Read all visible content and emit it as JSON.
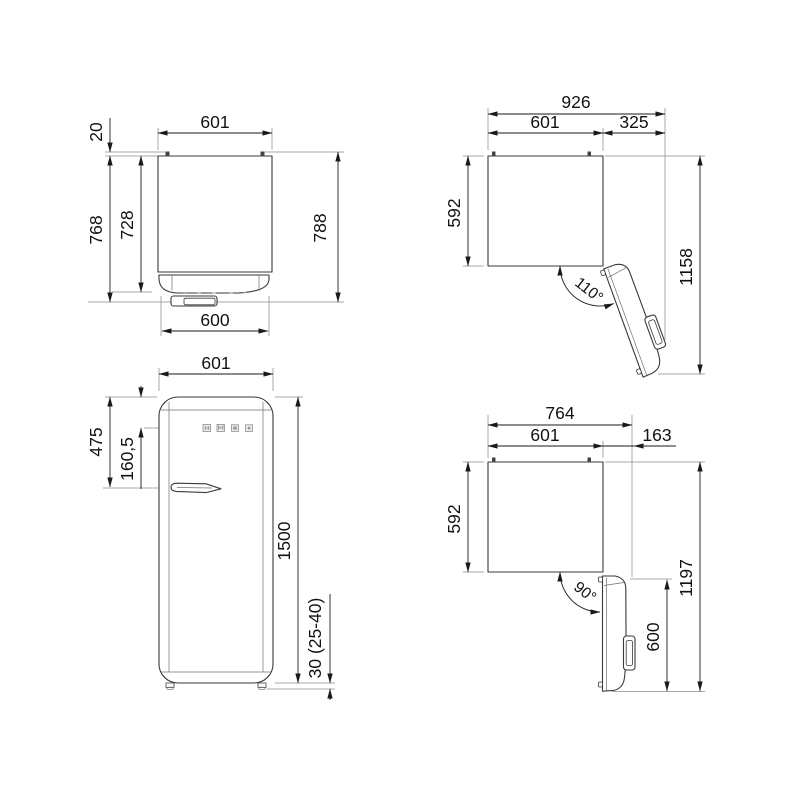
{
  "drawing": {
    "product": "refrigerator-dimension-diagram",
    "units": "mm",
    "views": {
      "plan_closed": {
        "width": "601",
        "hinge_protrusion": "20",
        "depth_no_door": "728",
        "depth_with_door": "768",
        "depth_overall": "788",
        "door_width": "600"
      },
      "plan_open_110": {
        "overall_width": "926",
        "width": "601",
        "door_protrusion": "325",
        "depth_no_door": "592",
        "overall_depth": "1158",
        "door_angle": "110°"
      },
      "front": {
        "width": "601",
        "handle_from_top": "475",
        "controls_from_top": "160,5",
        "height": "1500",
        "feet_height": "30 (25-40)"
      },
      "plan_open_90": {
        "overall_width": "764",
        "width": "601",
        "door_protrusion": "163",
        "depth_no_door": "592",
        "overall_depth": "1197",
        "door_width_open": "600",
        "door_angle": "90°"
      }
    }
  }
}
